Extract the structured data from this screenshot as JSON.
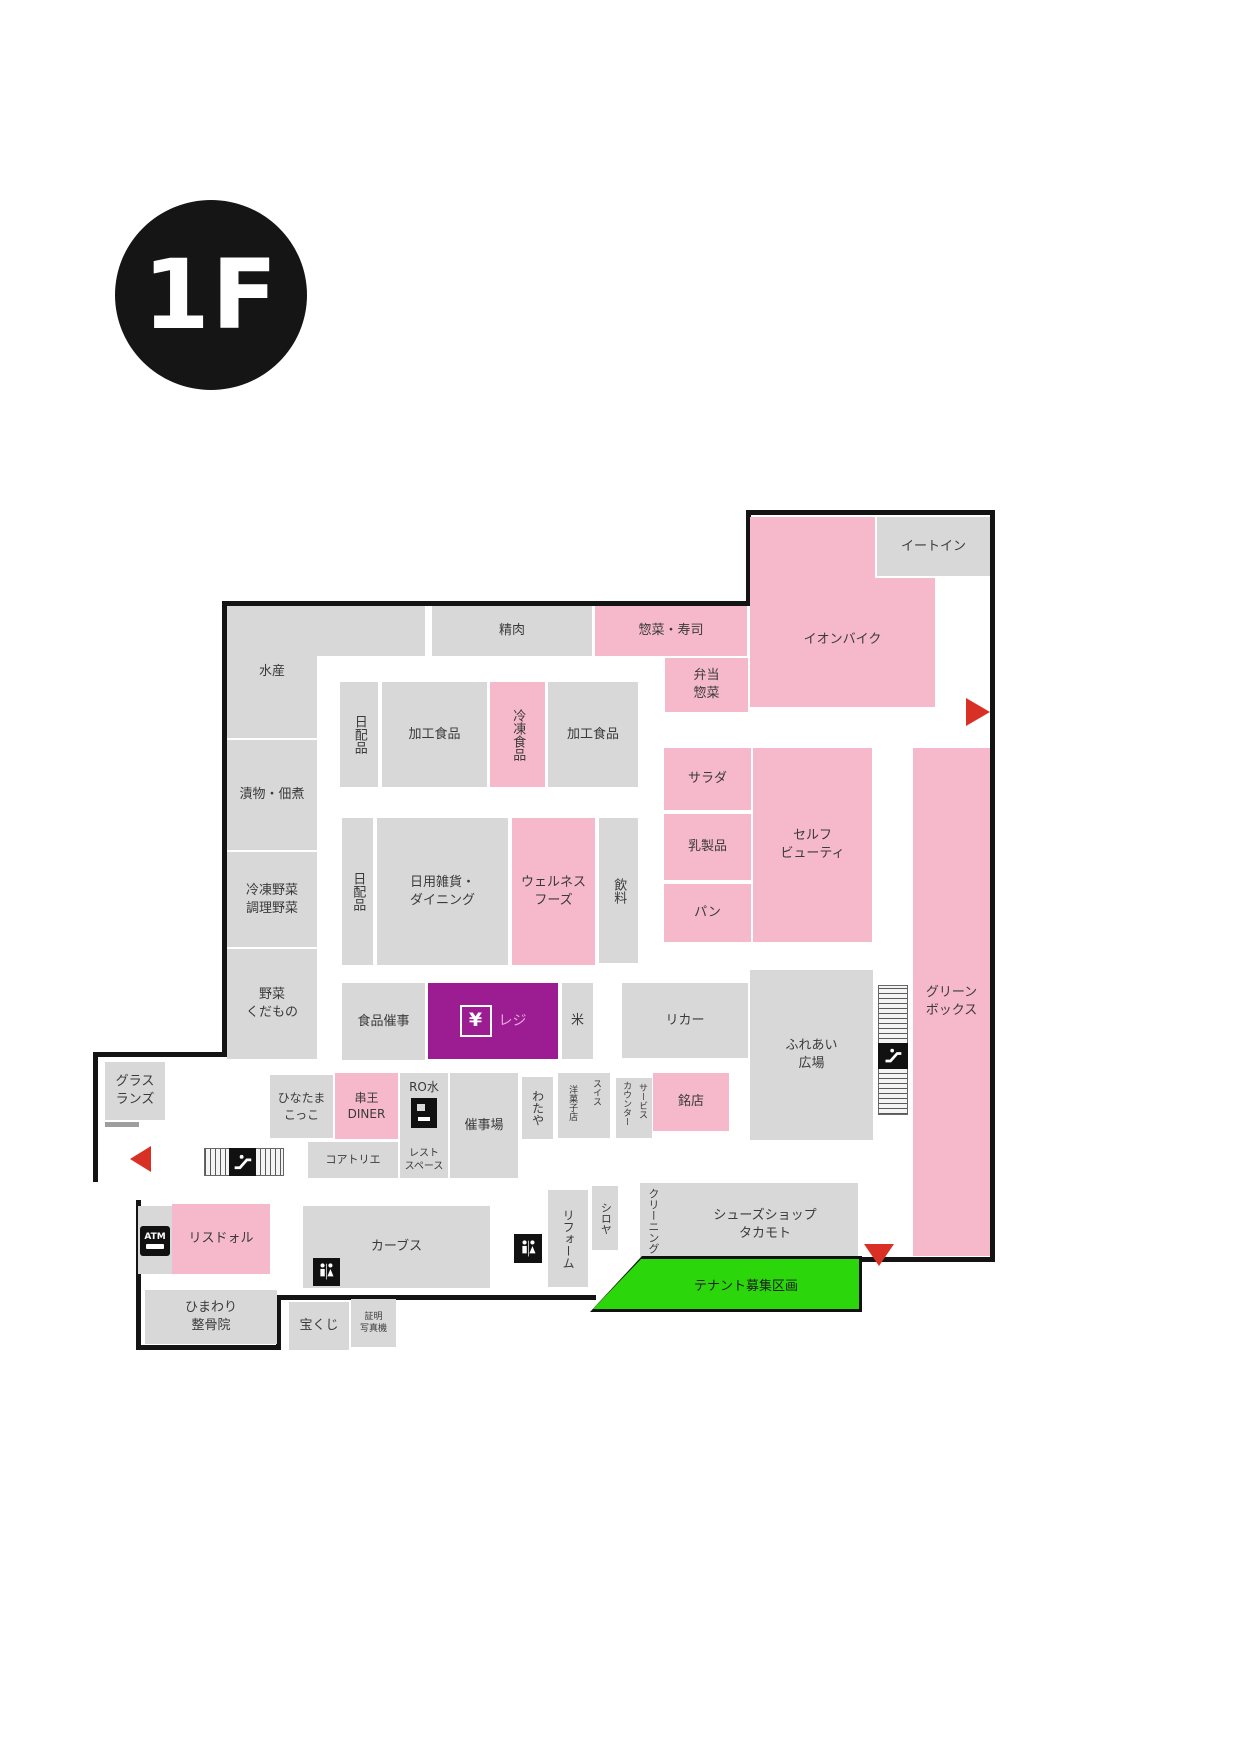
{
  "floor_badge": "1F",
  "colors": {
    "area_gray": "#d8d8d8",
    "area_pink": "#f6b9cc",
    "cashier_purple": "#9c1d92",
    "tenant_green": "#2bd60a",
    "boundary_black": "#141414",
    "arrow_red": "#d93025",
    "cashier_text_pink": "#e5a7d8"
  },
  "areas": {
    "suisan": "水産",
    "seiniku": "精肉",
    "souzai_sushi": "惣菜・寿司",
    "bento_souzai": "弁当\n惣菜",
    "ion_bike": "イオンバイク",
    "eat_in": "イートイン",
    "tsukemono": "漬物・佃煮",
    "reito_yasai": "冷凍野菜\n調理野菜",
    "yasai_kudamono": "野菜\nくだもの",
    "nichihai1": "日配品",
    "kako1": "加工食品",
    "reito_shokuhin": "冷凍食品",
    "kako2": "加工食品",
    "salad": "サラダ",
    "nyuseihin": "乳製品",
    "pan": "パン",
    "self_beauty": "セルフ\nビューティ",
    "nichihai2": "日配品",
    "zakka_dining": "日用雑貨・\nダイニング",
    "wellness": "ウェルネス\nフーズ",
    "inryo": "飲料",
    "green_box": "グリーン\nボックス",
    "shokuhin_saiji": "食品催事",
    "reji_yen": "¥",
    "reji_label": "レジ",
    "kome": "米",
    "liquor": "リカー",
    "fureai": "ふれあい\n広場",
    "glass_lands": "グラス\nランズ",
    "hinatama": "ひなたま\nこっこ",
    "kushio_diner": "串王\nDINER",
    "ro_water": "RO水",
    "koatorie": "コアトリエ",
    "rest_space": "レスト\nスペース",
    "saijijo": "催事場",
    "wataya": "わたや",
    "swiss_col1": "スイス",
    "swiss_col2": "洋菓子店",
    "service_col1": "サービス",
    "service_col2": "カウンター",
    "meiten": "銘店",
    "atm": "ATM",
    "lisdor": "リスドォル",
    "curves": "カーブス",
    "reform": "リフォーム",
    "shiroya": "シロヤ",
    "cleaning": "クリーニング",
    "shoes_takamoto": "シューズショップ\nタカモト",
    "tenant_recruit": "テナント募集区画",
    "himawari": "ひまわり\n整骨院",
    "takarakuji": "宝くじ",
    "shomei_photo": "証明\n写真機"
  },
  "icons": {
    "escalator": "escalator-icon",
    "restroom": "restroom-icon",
    "atm": "atm-icon",
    "water_dispenser": "water-dispenser-icon",
    "cashier_yen": "yen-icon",
    "entrance_arrows": [
      "left",
      "right",
      "down"
    ]
  }
}
